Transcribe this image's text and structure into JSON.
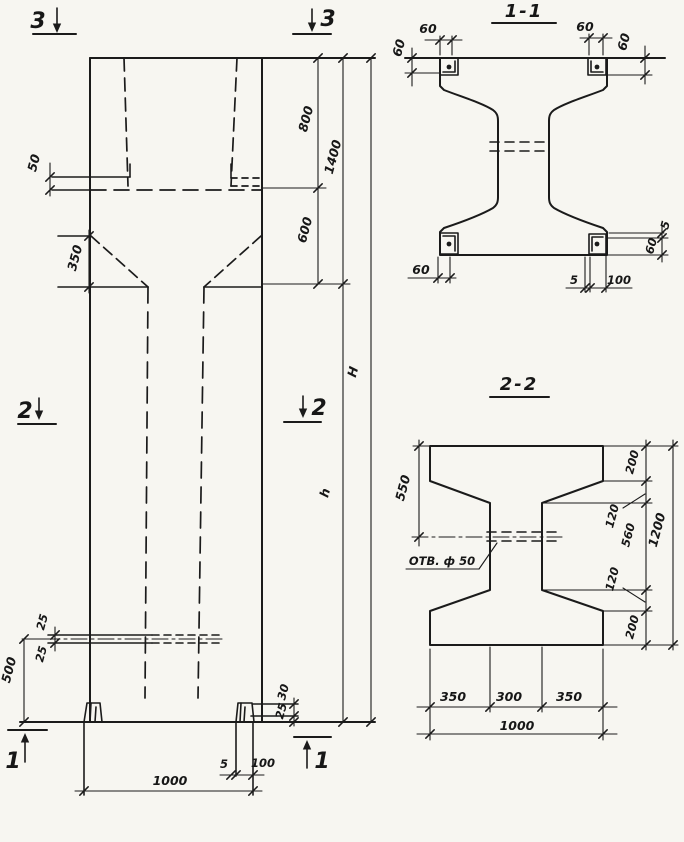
{
  "markers": {
    "m3_left": "3",
    "m3_right": "3",
    "m2_left": "2",
    "m2_right": "2",
    "m1_left": "1",
    "m1_right": "1"
  },
  "elevation": {
    "dims": {
      "d50": "50",
      "d350": "350",
      "d800": "800",
      "d1400": "1400",
      "d600": "600",
      "dH": "H",
      "dh": "h",
      "d25a": "25",
      "d25b": "25",
      "d500": "500",
      "d30": "30",
      "d25c": "25",
      "d5": "5",
      "d100": "100",
      "d1000": "1000"
    }
  },
  "section_1_1": {
    "title": "1-1",
    "dims": {
      "tl60": "60",
      "tr60": "60",
      "left60": "60",
      "right60": "60",
      "bl60": "60",
      "b5": "5",
      "b100": "100",
      "r5": "5",
      "r60": "60"
    }
  },
  "section_2_2": {
    "title": "2-2",
    "hole_label": "ОТВ. ф 50",
    "dims": {
      "d550": "550",
      "d200a": "200",
      "d120a": "120",
      "d560": "560",
      "d120b": "120",
      "d200b": "200",
      "d1200": "1200",
      "d350a": "350",
      "d300": "300",
      "d350b": "350",
      "d1000": "1000"
    }
  }
}
